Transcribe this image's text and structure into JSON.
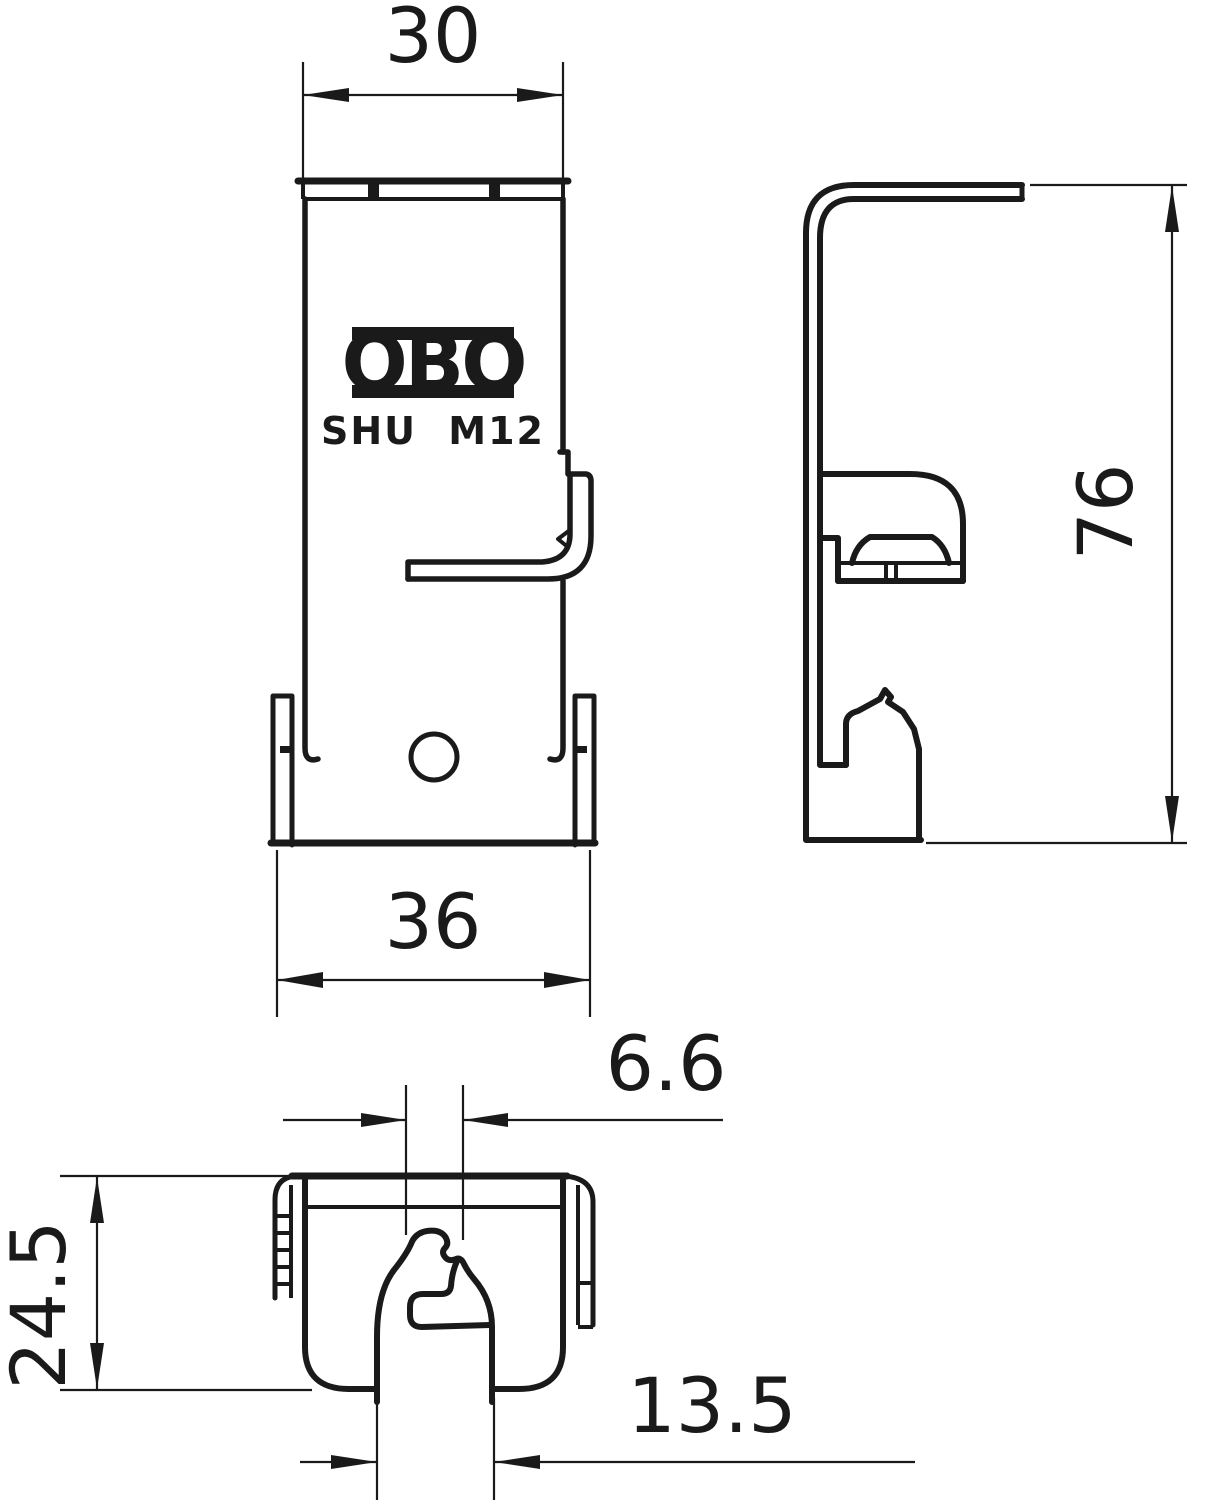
{
  "drawing": {
    "brand_logo": "OBO",
    "model_label": "SHU M12",
    "dimensions": {
      "top_width": "30",
      "bottom_width": "36",
      "height": "76",
      "slot_width": "6.6",
      "depth": "24.5",
      "tab_width": "13.5"
    },
    "colors": {
      "line": "#1a1a1a",
      "background": "#ffffff"
    }
  }
}
